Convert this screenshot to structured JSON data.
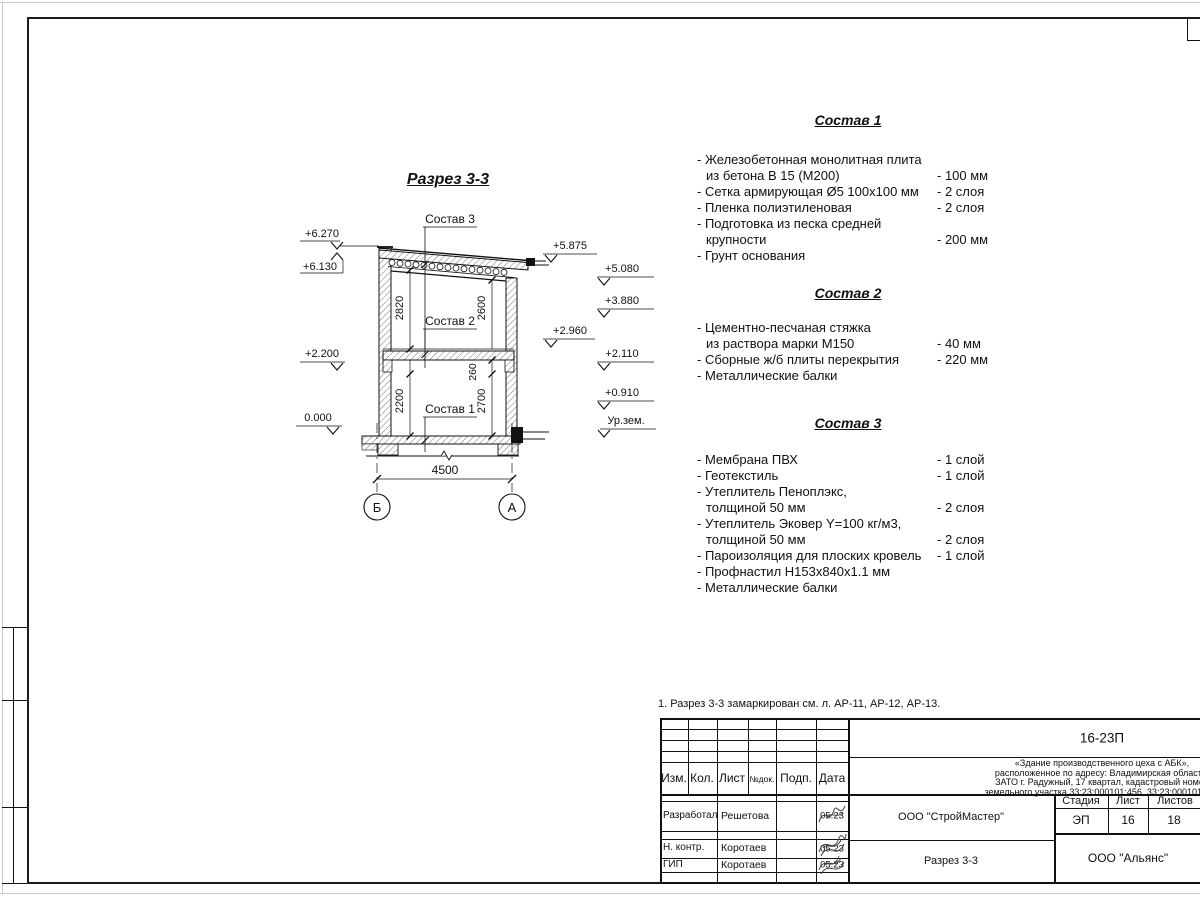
{
  "drawing": {
    "title": "Разрез 3-3",
    "callouts": [
      "Состав 1",
      "Состав 2",
      "Состав 3"
    ],
    "elev_left": [
      "+6.270",
      "+6.130",
      "+2.200",
      "0.000"
    ],
    "elev_right": [
      "+5.875",
      "+5.080",
      "+3.880",
      "+2.960",
      "+2.110",
      "+0.910",
      "Ур.зем."
    ],
    "dims": [
      "2820",
      "2600",
      "2200",
      "260",
      "2700"
    ],
    "span": "4500",
    "axis_left": "Б",
    "axis_right": "А"
  },
  "compositions": [
    {
      "title": "Состав 1",
      "items": [
        {
          "l1": "- Железобетонная  монолитная плита",
          "l2": "из бетона В 15 (М200)",
          "val": "- 100 мм"
        },
        {
          "l1": "- Сетка армирующая Ø5 100х100 мм",
          "val": "- 2 слоя"
        },
        {
          "l1": "- Пленка полиэтиленовая",
          "val": "- 2 слоя"
        },
        {
          "l1": "- Подготовка из песка средней",
          "l2": "крупности",
          "val": "- 200 мм"
        },
        {
          "l1": "- Грунт основания",
          "val": ""
        }
      ]
    },
    {
      "title": "Состав 2",
      "items": [
        {
          "l1": "- Цементно-песчаная стяжка",
          "l2": "из раствора марки М150",
          "val": "- 40 мм"
        },
        {
          "l1": "- Сборные ж/б плиты перекрытия",
          "val": "- 220 мм"
        },
        {
          "l1": "- Металлические балки",
          "val": ""
        }
      ]
    },
    {
      "title": "Состав 3",
      "items": [
        {
          "l1": "- Мембрана ПВХ",
          "val": "- 1 слой"
        },
        {
          "l1": "- Геотекстиль",
          "val": "- 1 слой"
        },
        {
          "l1": "- Утеплитель Пеноплэкс,",
          "l2": "толщиной 50 мм",
          "val": "- 2 слоя"
        },
        {
          "l1": "- Утеплитель Эковер Y=100 кг/м3,",
          "l2": "толщиной 50 мм",
          "val": "- 2 слоя"
        },
        {
          "l1": "- Пароизоляция для плоских кровель",
          "val": "- 1 слой"
        },
        {
          "l1": "- Профнастил Н153х840х1.1 мм",
          "val": ""
        },
        {
          "l1": "- Металлические балки",
          "val": ""
        }
      ]
    }
  ],
  "note": "1. Разрез 3-3 замаркирован см. л. АР-11, АР-12, АР-13.",
  "title_block": {
    "doc_code": "16-23П",
    "desc1": "«Здание производственного цеха с АБК»,",
    "desc2": "расположенное по адресу: Владимирская область,",
    "desc3": "ЗАТО г. Радужный, 17 квартал, кадастровый номер",
    "desc4": "земельного участка 33:23:000101:456, 33:23:000101:508",
    "col_izm": "Изм.",
    "col_kol": "Кол.",
    "col_list": "Лист",
    "col_dok": "№док.",
    "col_podp": "Подп.",
    "col_data": "Дата",
    "row1_role": "Разработал",
    "row1_name": "Решетова",
    "row1_date": "05.23",
    "row2_role": "Н. контр.",
    "row2_name": "Коротаев",
    "row2_date": "05.23",
    "row3_role": "ГИП",
    "row3_name": "Коротаев",
    "row3_date": "05.23",
    "contractor": "ООО \"СтройМастер\"",
    "sheet_title": "Разрез 3-3",
    "stage_label": "Стадия",
    "sheet_label": "Лист",
    "sheets_label": "Листов",
    "stage": "ЭП",
    "sheet_no": "16",
    "sheets_total": "18",
    "client": "ООО \"Альянс\""
  }
}
